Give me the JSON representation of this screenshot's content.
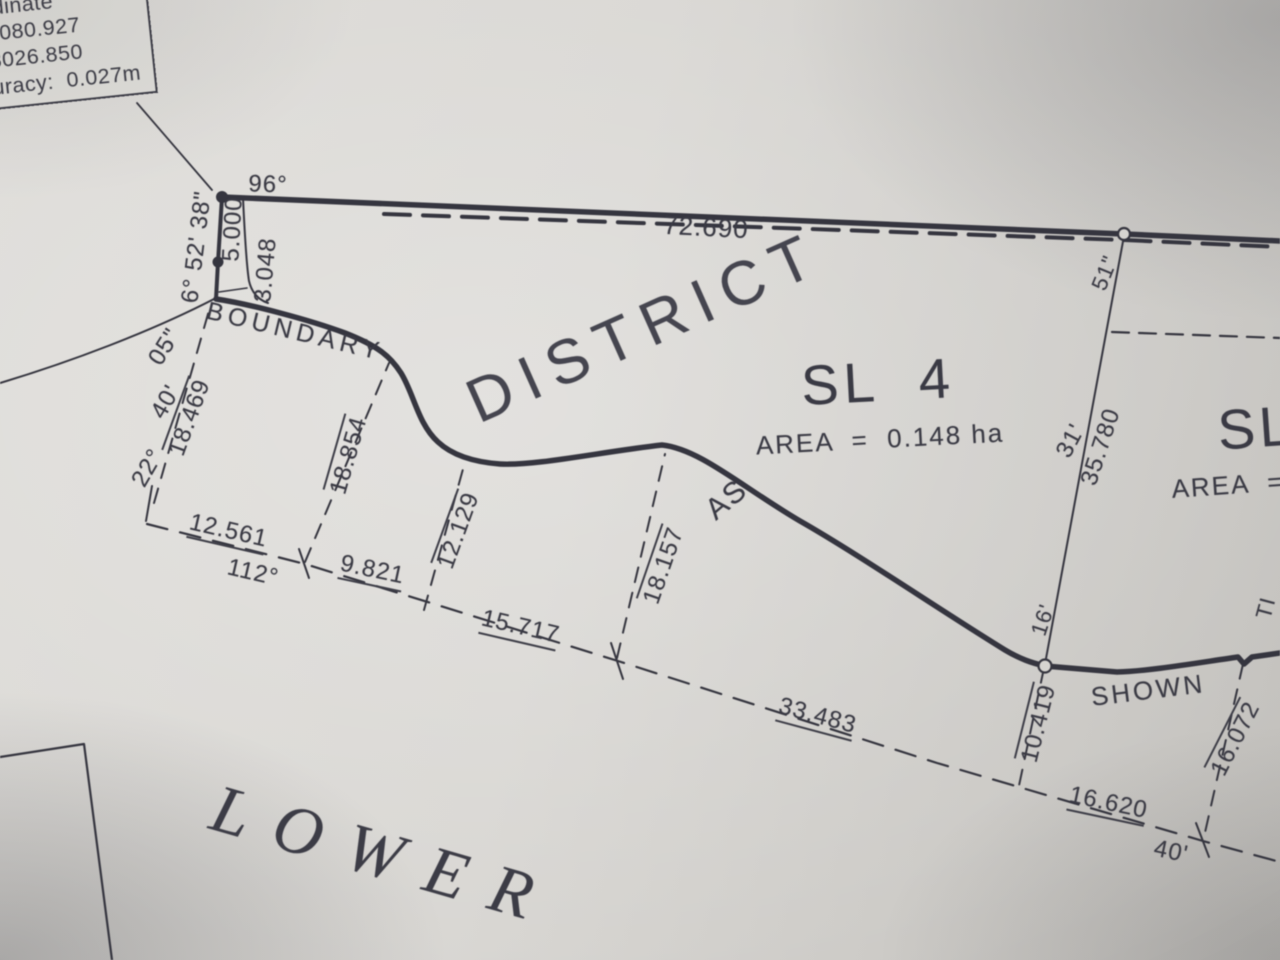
{
  "info_box": {
    "line1": "2002.0",
    "line2": "rdinate",
    "line3": "5080.927",
    "line4": "3026.850",
    "line5": "uracy:  0.027m"
  },
  "labels": {
    "district": "DISTRICT",
    "boundary": "BOUNDARY",
    "as": "AS",
    "shown": "SHOWN",
    "lower": "LOWER",
    "sl4": "SL  4",
    "sl4_area": "AREA  =  0.148 ha",
    "sl_right": "SL",
    "area_right": "AREA  =",
    "ti": "TI"
  },
  "dims": {
    "d72690": "72.690",
    "d5000": "5.000",
    "d3048": "3.048",
    "d18469": "18.469",
    "d18854": "18.854",
    "d12129": "12.129",
    "d12561": "12.561",
    "d9821": "9.821",
    "d15717": "15.717",
    "d18157": "18.157",
    "d33483": "33.483",
    "d10419": "10.419",
    "d35780": "35.780",
    "d16072": "16.072",
    "d16620": "16.620"
  },
  "angles": {
    "a96": "96°",
    "a65238": "6° 52' 38\"",
    "a05": "05\"",
    "a40": "40'",
    "a22": "22°",
    "a112": "112°",
    "a51": "51\"",
    "a31": "31'",
    "a16": "16'",
    "a40b": "40'"
  },
  "colors": {
    "ink": "#3a3a44",
    "paper": "#d6d4d0"
  }
}
